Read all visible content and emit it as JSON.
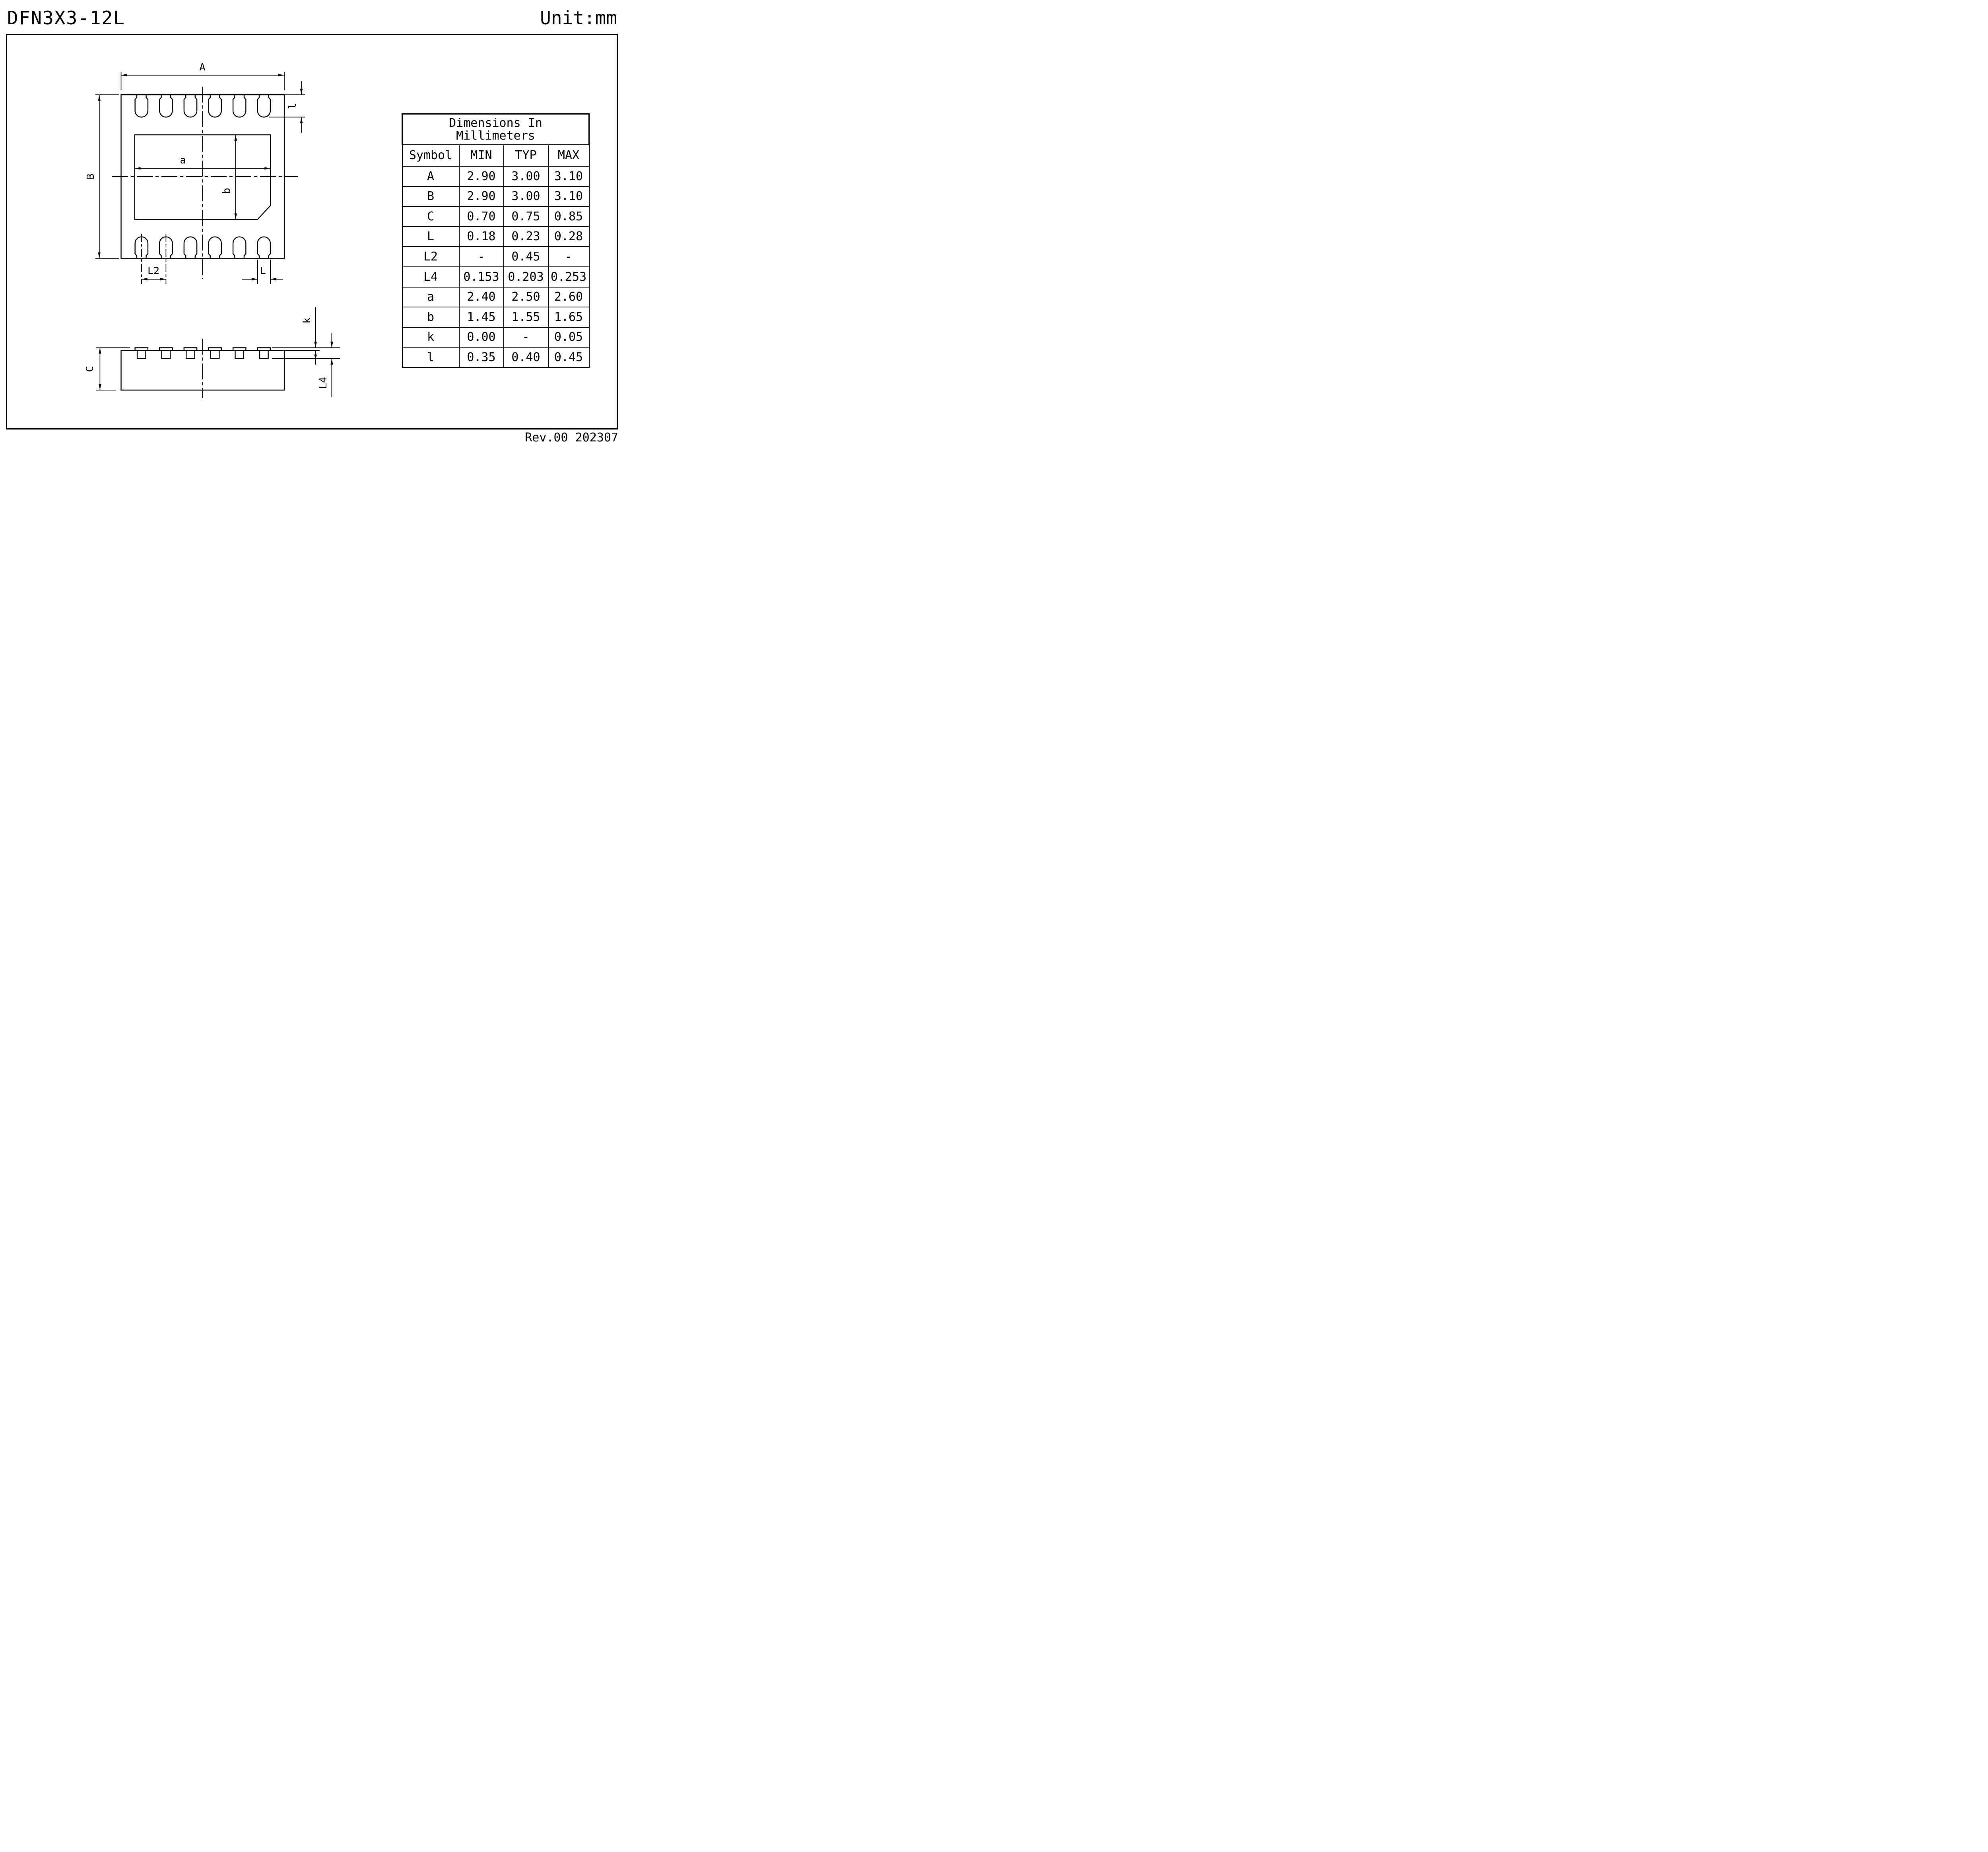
{
  "page": {
    "title": "DFN3X3-12L",
    "unit": "Unit:mm",
    "revision": "Rev.00 202307"
  },
  "drawing": {
    "labels": {
      "overall_width": "A",
      "overall_height": "B",
      "epad_width": "a",
      "epad_height": "b",
      "pad_length": "l",
      "pad_pitch": "L2",
      "pad_width": "L",
      "body_thickness": "C",
      "lead_protrusion": "k",
      "lead_thickness": "L4"
    }
  },
  "table": {
    "title_line1": "Dimensions In",
    "title_line2": "Millimeters",
    "headers": [
      "Symbol",
      "MIN",
      "TYP",
      "MAX"
    ],
    "rows": [
      {
        "symbol": "A",
        "min": "2.90",
        "typ": "3.00",
        "max": "3.10"
      },
      {
        "symbol": "B",
        "min": "2.90",
        "typ": "3.00",
        "max": "3.10"
      },
      {
        "symbol": "C",
        "min": "0.70",
        "typ": "0.75",
        "max": "0.85"
      },
      {
        "symbol": "L",
        "min": "0.18",
        "typ": "0.23",
        "max": "0.28"
      },
      {
        "symbol": "L2",
        "min": "-",
        "typ": "0.45",
        "max": "-"
      },
      {
        "symbol": "L4",
        "min": "0.153",
        "typ": "0.203",
        "max": "0.253"
      },
      {
        "symbol": "a",
        "min": "2.40",
        "typ": "2.50",
        "max": "2.60"
      },
      {
        "symbol": "b",
        "min": "1.45",
        "typ": "1.55",
        "max": "1.65"
      },
      {
        "symbol": "k",
        "min": "0.00",
        "typ": "-",
        "max": "0.05"
      },
      {
        "symbol": "l",
        "min": "0.35",
        "typ": "0.40",
        "max": "0.45"
      }
    ]
  }
}
